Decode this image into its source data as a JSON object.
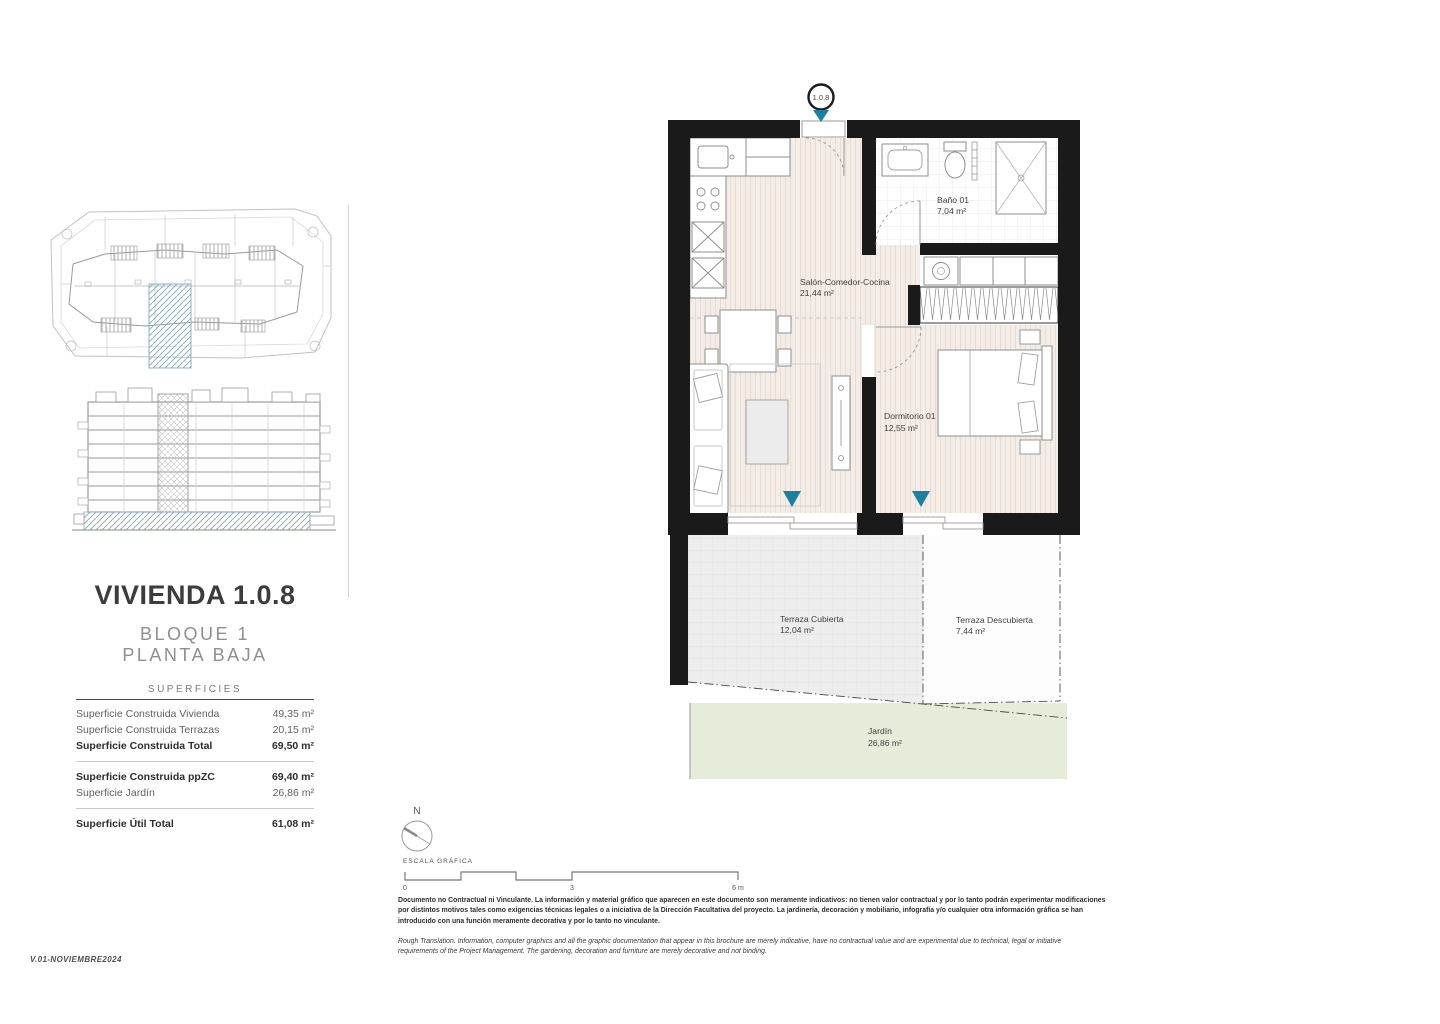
{
  "page": {
    "version": "V.01-NOVIEMBRE2024"
  },
  "unit": {
    "badge": "1.0.8",
    "title": "VIVIENDA 1.0.8",
    "block": "BLOQUE 1",
    "floor": "PLANTA BAJA"
  },
  "surfaces": {
    "header": "SUPERFICIES",
    "rows": [
      {
        "label": "Superficie Construida Vivienda",
        "value": "49,35 m²"
      },
      {
        "label": "Superficie Construida Terrazas",
        "value": "20,15 m²"
      },
      {
        "label": "Superficie Construida Total",
        "value": "69,50 m²"
      },
      {
        "label": "Superficie Construida ppZC",
        "value": "69,40 m²"
      },
      {
        "label": "Superficie Jardín",
        "value": "26,86 m²"
      },
      {
        "label": "Superficie Útil Total",
        "value": "61,08 m²"
      }
    ]
  },
  "plan": {
    "rooms": {
      "salon": {
        "name": "Salón-Comedor-Cocina",
        "area": "21,44 m²"
      },
      "bano": {
        "name": "Baño 01",
        "area": "7,04 m²"
      },
      "dormitorio": {
        "name": "Dormitorio 01",
        "area": "12,55 m²"
      },
      "terraza_cubierta": {
        "name": "Terraza Cubierta",
        "area": "12,04 m²"
      },
      "terraza_descubierta": {
        "name": "Terraza Descubierta",
        "area": "7,44 m²"
      },
      "jardin": {
        "name": "Jardín",
        "area": "26,86 m²"
      }
    }
  },
  "scale": {
    "north": "N",
    "label": "ESCALA GRÁFICA",
    "tick_0": "0",
    "tick_3": "3",
    "tick_6": "6 m"
  },
  "disclaimer": {
    "es": "Documento no Contractual ni Vinculante. La información y material gráfico que aparecen en este documento son meramente indicativos: no tienen valor contractual y por lo tanto podrán experimentar modificaciones por distintos motivos tales como exigencias técnicas legales o a iniciativa de la Dirección Facultativa del proyecto. La jardinería, decoración y mobiliario, infografía y/o cualquier otra información gráfica se han introducido con una función meramente decorativa y por lo tanto no vinculante.",
    "en": "Rough Translation. Information, computer graphics and all the graphic documentation that appear in this brochure are merely indicative, have no contractual value and are experimental due to technical, legal or initiative requirements of the Project Management. The gardening, decoration and furniture are merely decorative and not binding."
  },
  "colors": {
    "accent_teal": "#1d7fa0",
    "highlight_hatch": "#8fb0c0",
    "garden_green": "#e5ecd9",
    "wall_black": "#1a1a1a"
  }
}
